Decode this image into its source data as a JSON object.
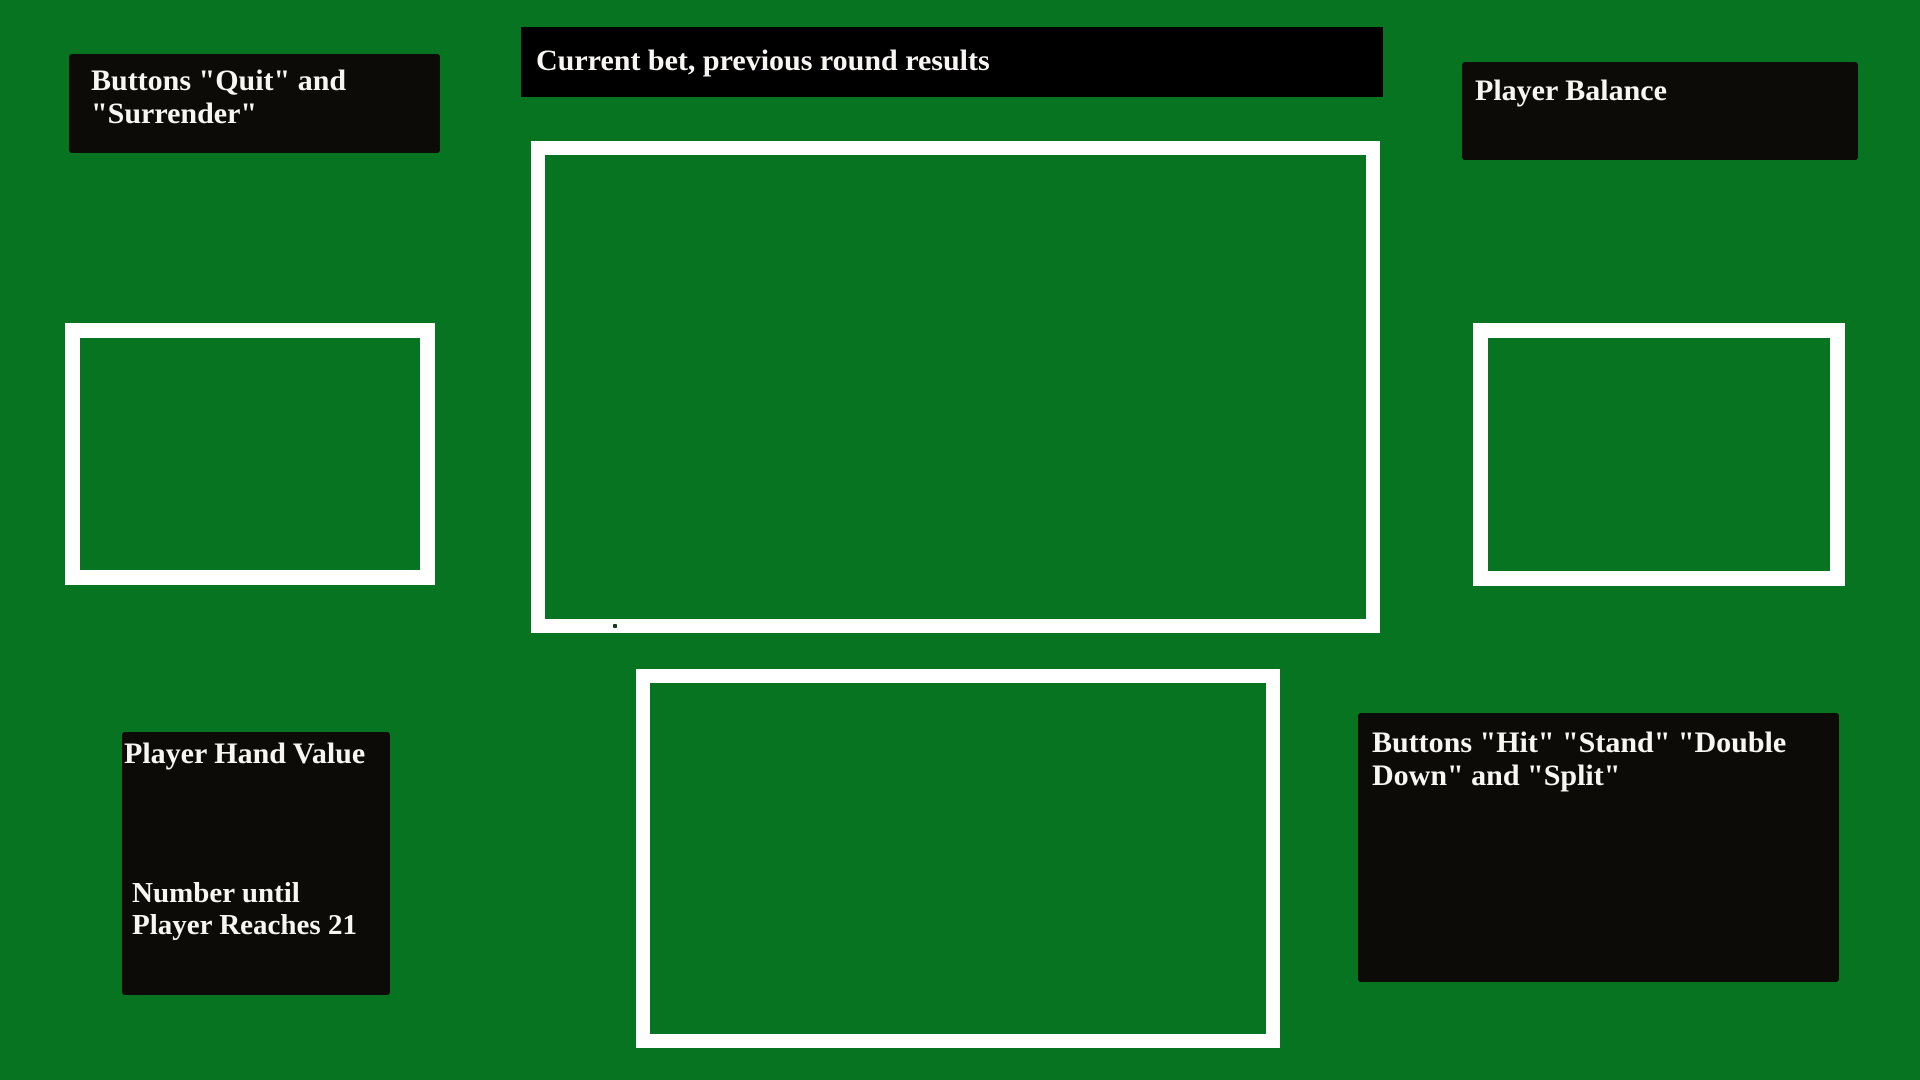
{
  "colors": {
    "background": "#077421",
    "frame_border": "#ffffff",
    "label_box_bg": "#0c0b08",
    "top_bar_bg": "#000000",
    "label_text": "#f7f6f2",
    "dot": "#123b17"
  },
  "annotations": {
    "quit_surrender_label": "Buttons \"Quit\" and\n\"Surrender\"",
    "current_bet_label": "Current bet, previous round results",
    "player_balance_label": "Player Balance",
    "player_hand_value_label": "Player Hand Value",
    "number_until_21_label": "Number until\nPlayer Reaches 21",
    "action_buttons_label": "Buttons \"Hit\" \"Stand\" \"Double\nDown\" and \"Split\""
  }
}
